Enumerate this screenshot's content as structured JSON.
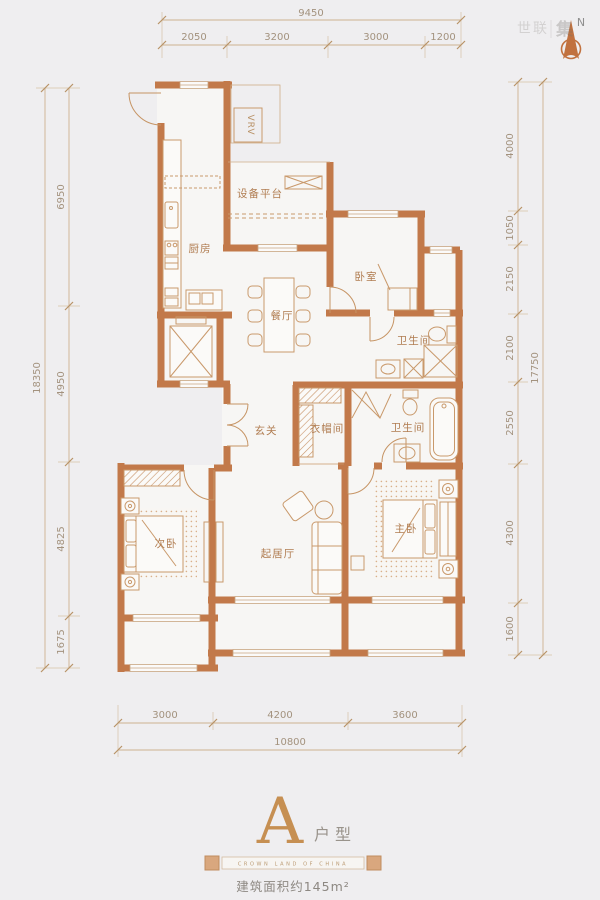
{
  "meta": {
    "plan_name": "A",
    "plan_suffix": "户型",
    "area_text": "建筑面积约145m²",
    "divider_text": "CROWN LAND OF CHINA",
    "north_label": "N",
    "watermark_left": "世联",
    "watermark_right": "集"
  },
  "rooms": {
    "kitchen": "厨房",
    "equipment_platform": "设备平台",
    "vrv": "VRV",
    "dining": "餐厅",
    "bedroom": "卧室",
    "bath_upper": "卫生间",
    "bath_lower": "卫生间",
    "foyer": "玄关",
    "cloakroom": "衣帽间",
    "second_bedroom": "次卧",
    "living": "起居厅",
    "master_bedroom": "主卧"
  },
  "dimensions": {
    "top": {
      "overall": "9450",
      "segments": [
        "2050",
        "3200",
        "3000",
        "1200"
      ]
    },
    "bottom": {
      "overall": "10800",
      "segments": [
        "3000",
        "4200",
        "3600"
      ]
    },
    "left": {
      "overall": "18350",
      "segments": [
        "6950",
        "4950",
        "4825",
        "1675"
      ]
    },
    "right": {
      "overall": "17750",
      "segments": [
        "4000",
        "1050",
        "2150",
        "2100",
        "2550",
        "4300",
        "1600"
      ]
    }
  },
  "colors": {
    "wall": "#c2794a",
    "furniture_line": "#c9996b",
    "dimension_line": "#ccb190",
    "label": "#b07c50",
    "accent": "#c68f52",
    "background": "#efeef0"
  }
}
